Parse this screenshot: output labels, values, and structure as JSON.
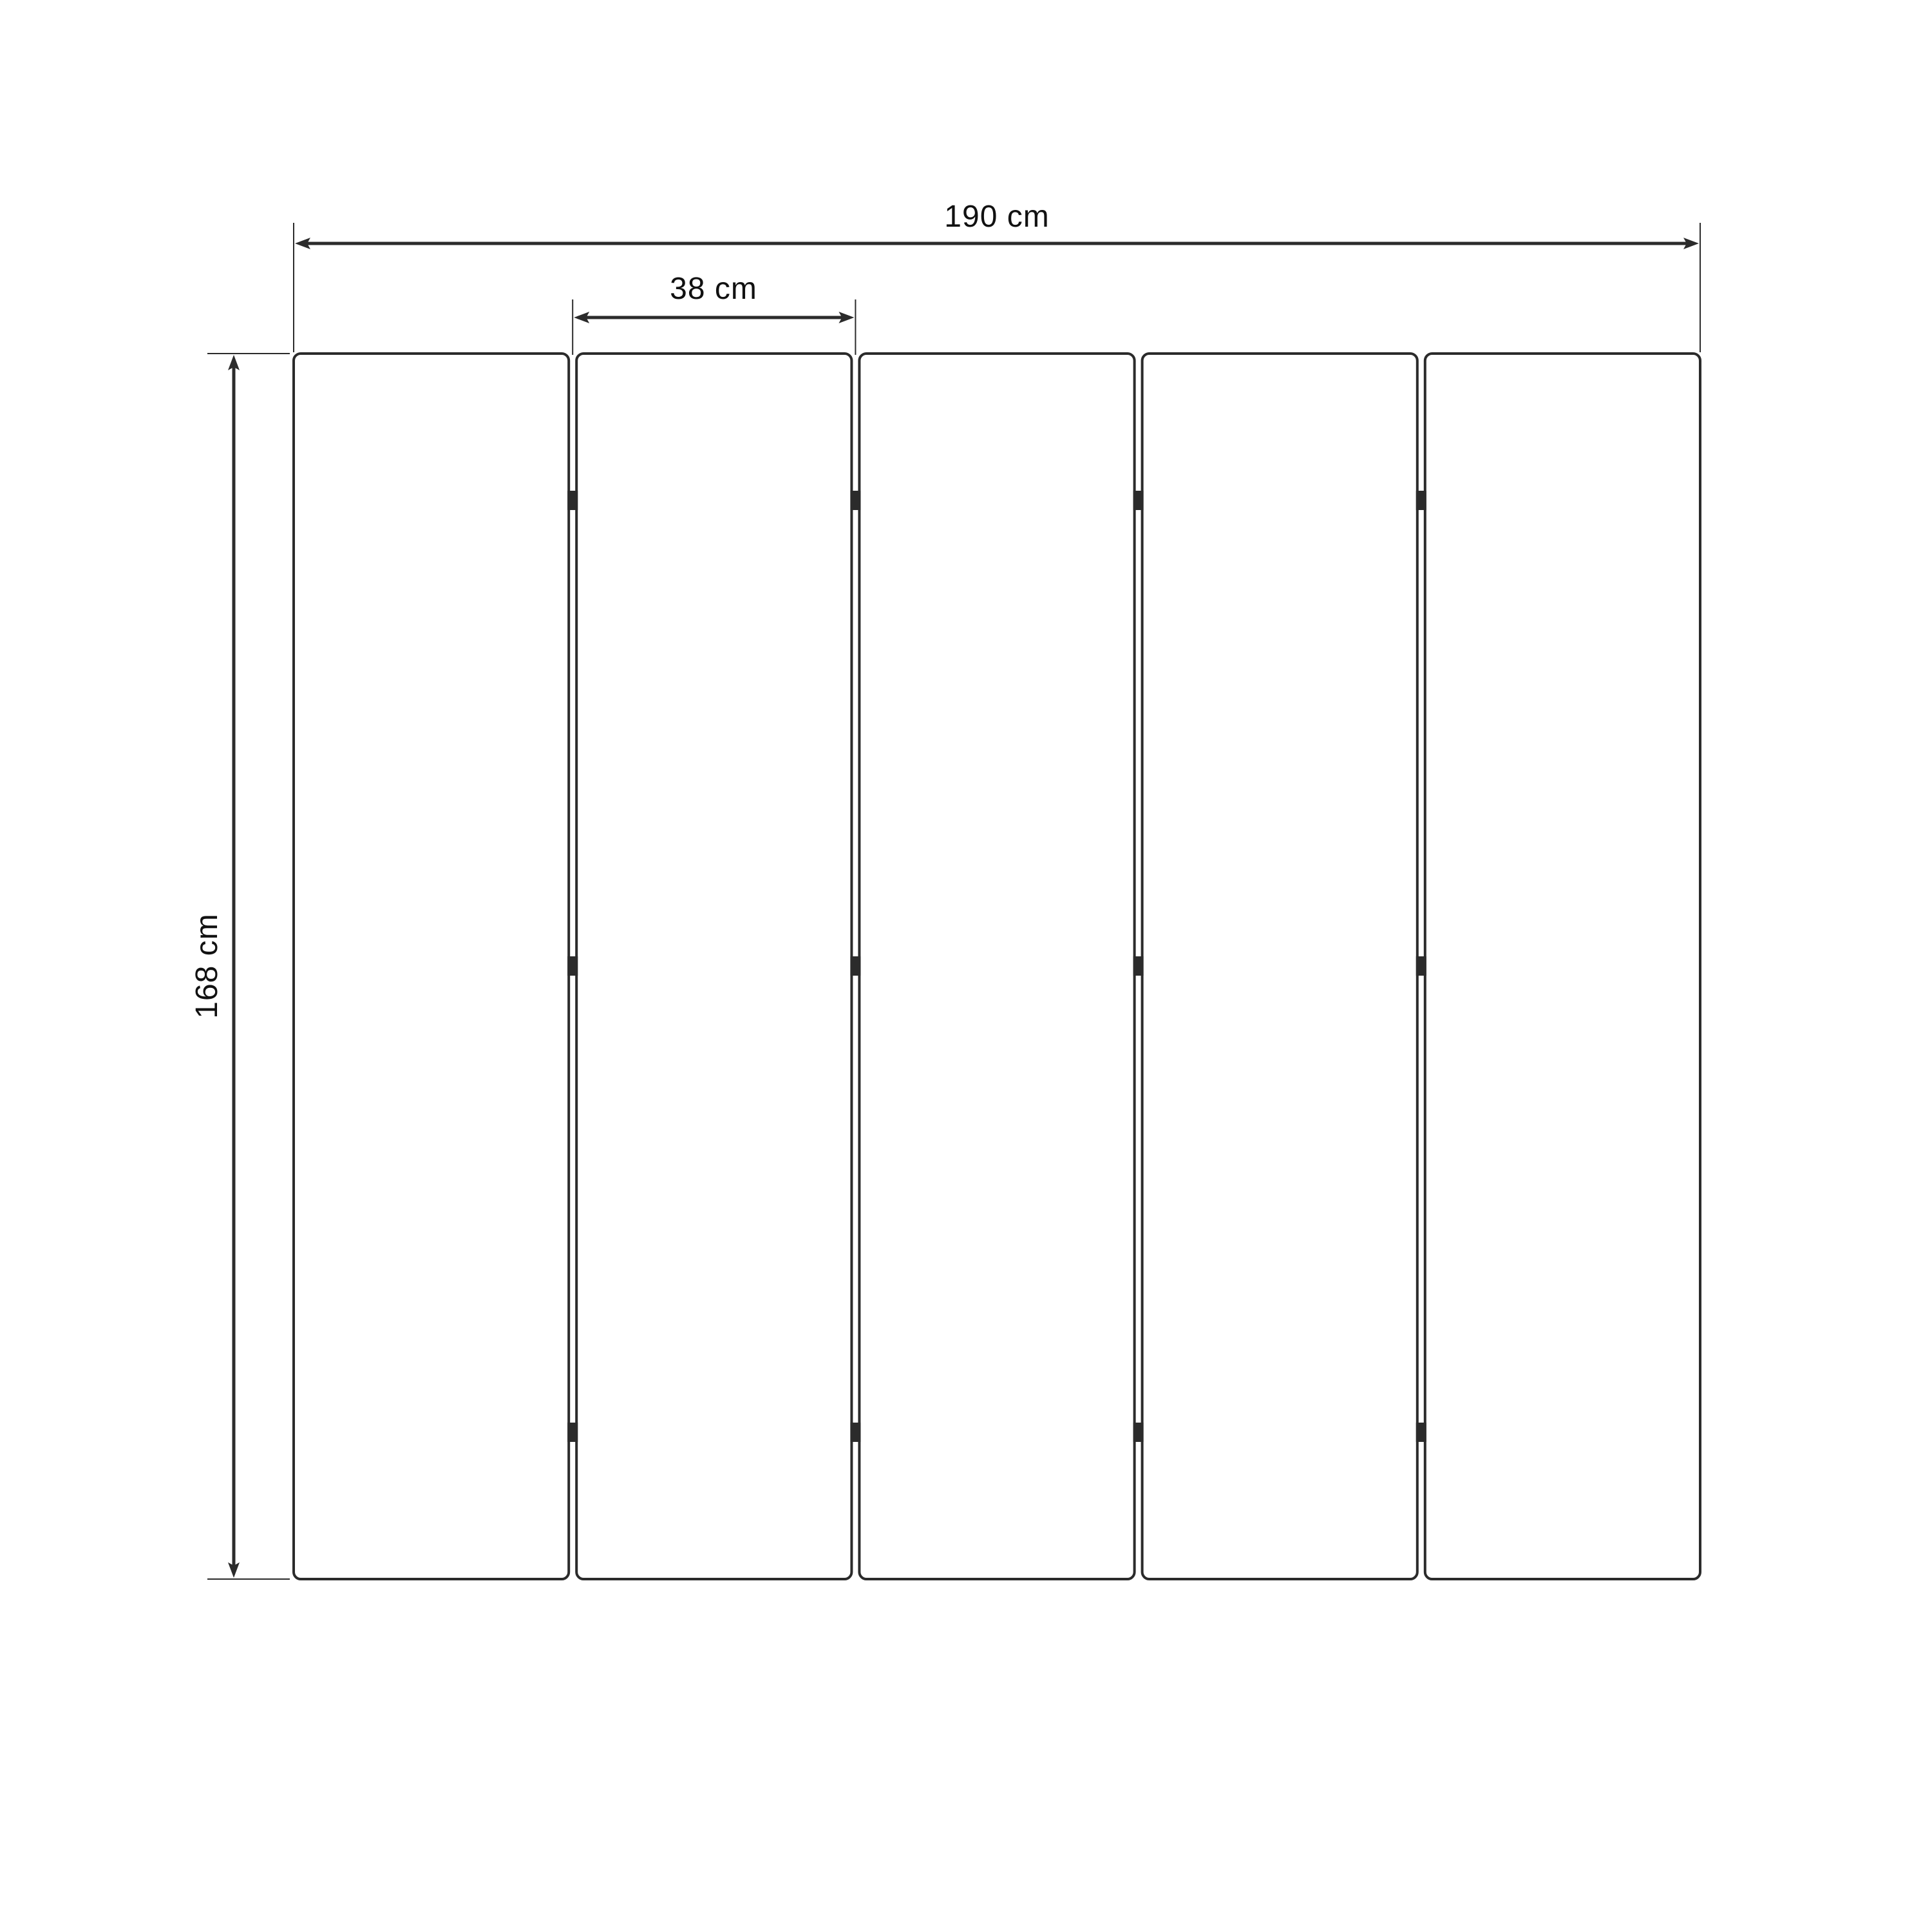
{
  "diagram": {
    "kind": "dimension-drawing",
    "panel_count": 5,
    "hinge_rows_per_joint": 3
  },
  "dimensions": {
    "total_width": "190 cm",
    "panel_width": "38 cm",
    "height": "168 cm"
  },
  "colors": {
    "line": "#2b2b2b",
    "text": "#111111",
    "background": "#ffffff"
  }
}
